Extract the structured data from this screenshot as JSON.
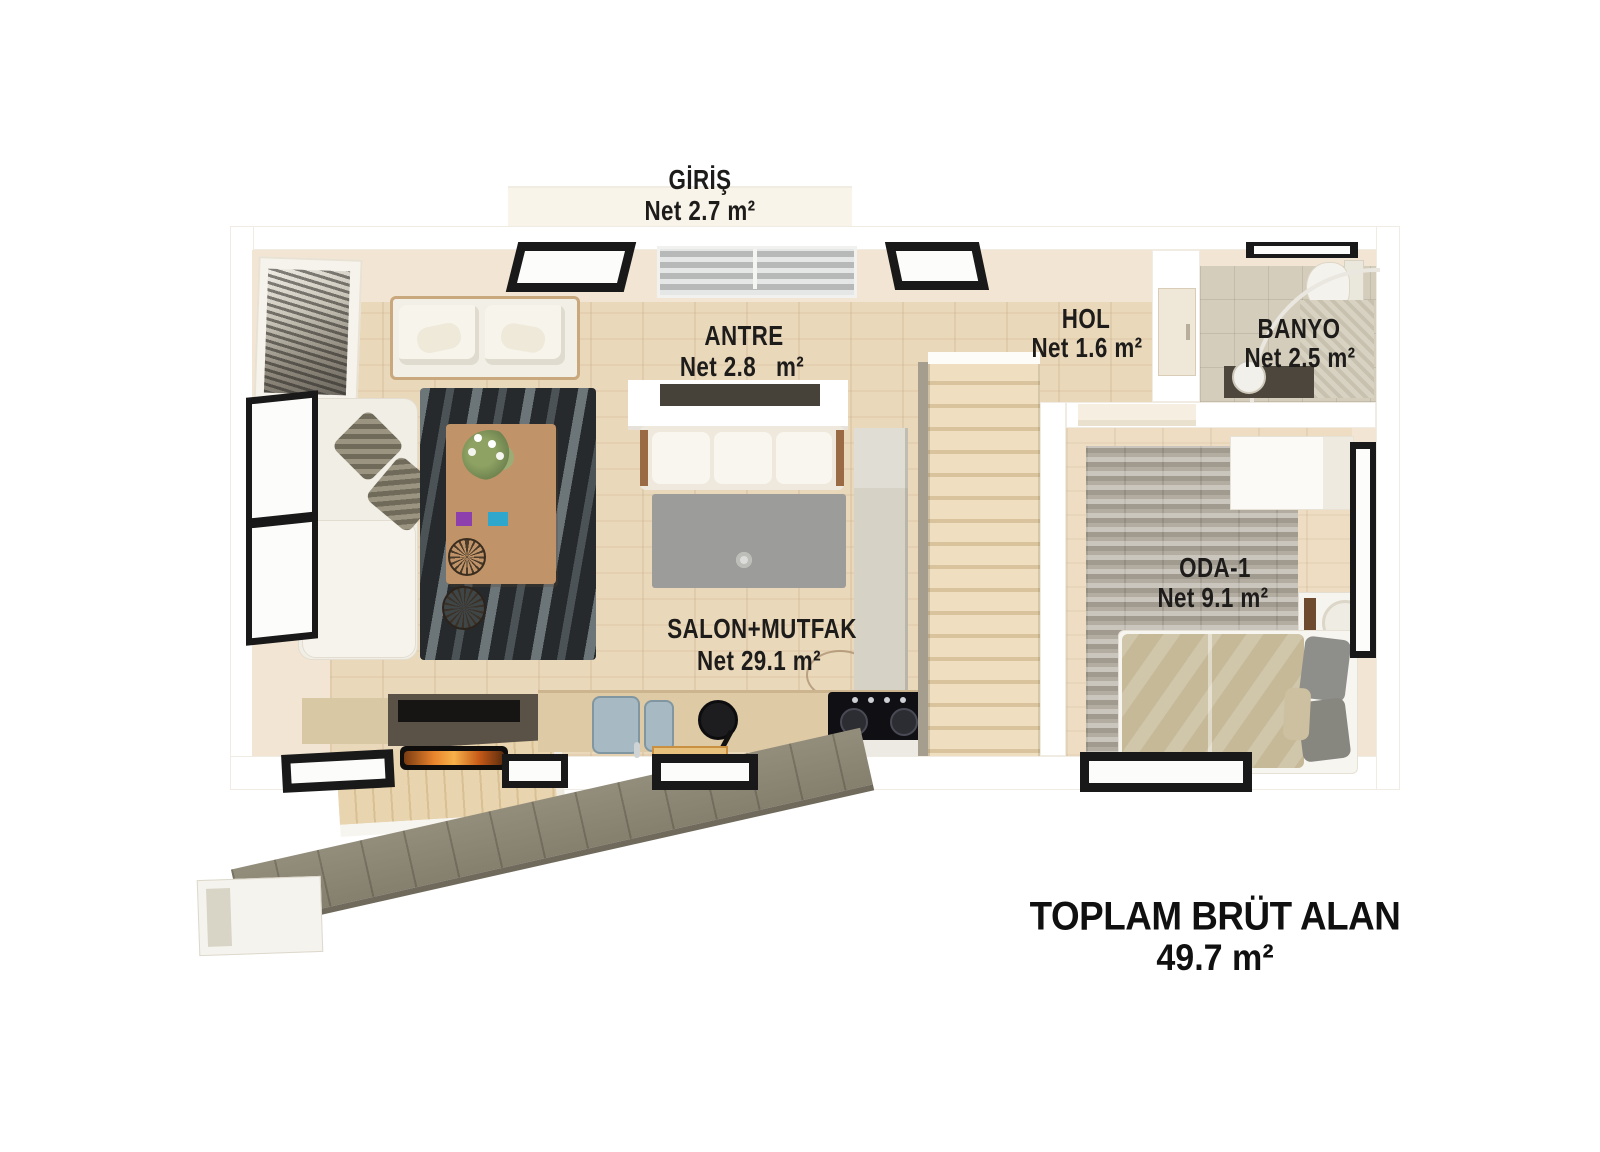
{
  "plan_title": "floor-plan",
  "rooms": [
    {
      "id": "giris",
      "name": "GİRİŞ",
      "area": "Net 2.7 m²"
    },
    {
      "id": "antre",
      "name": "ANTRE",
      "area": "Net 2.8   m²"
    },
    {
      "id": "hol",
      "name": "HOL",
      "area": "Net 1.6 m²"
    },
    {
      "id": "banyo",
      "name": "BANYO",
      "area": "Net 2.5 m²"
    },
    {
      "id": "salon_mutfak",
      "name": "SALON+MUTFAK",
      "area": "Net 29.1 m²"
    },
    {
      "id": "oda_1",
      "name": "ODA-1",
      "area": "Net 9.1 m²"
    }
  ],
  "total": {
    "label": "TOPLAM BRÜT ALAN",
    "value": "49.7 m²"
  },
  "colors": {
    "background": "#ffffff",
    "wall_face": "#f3e5d3",
    "wood_floor": "#ead8ba",
    "bedroom_floor": "#eeddc2",
    "bathroom_tile": "#d5cdbc",
    "zebra_rug": "#262a2c",
    "stone_rug": "#b3ada1",
    "walkway_stone": "#8b8574",
    "window_frame": "#191919",
    "label_text": "#1d1c1a",
    "duvet": "#c6b998",
    "tv_unit": "#5a5147",
    "fire": "#e8842c"
  }
}
